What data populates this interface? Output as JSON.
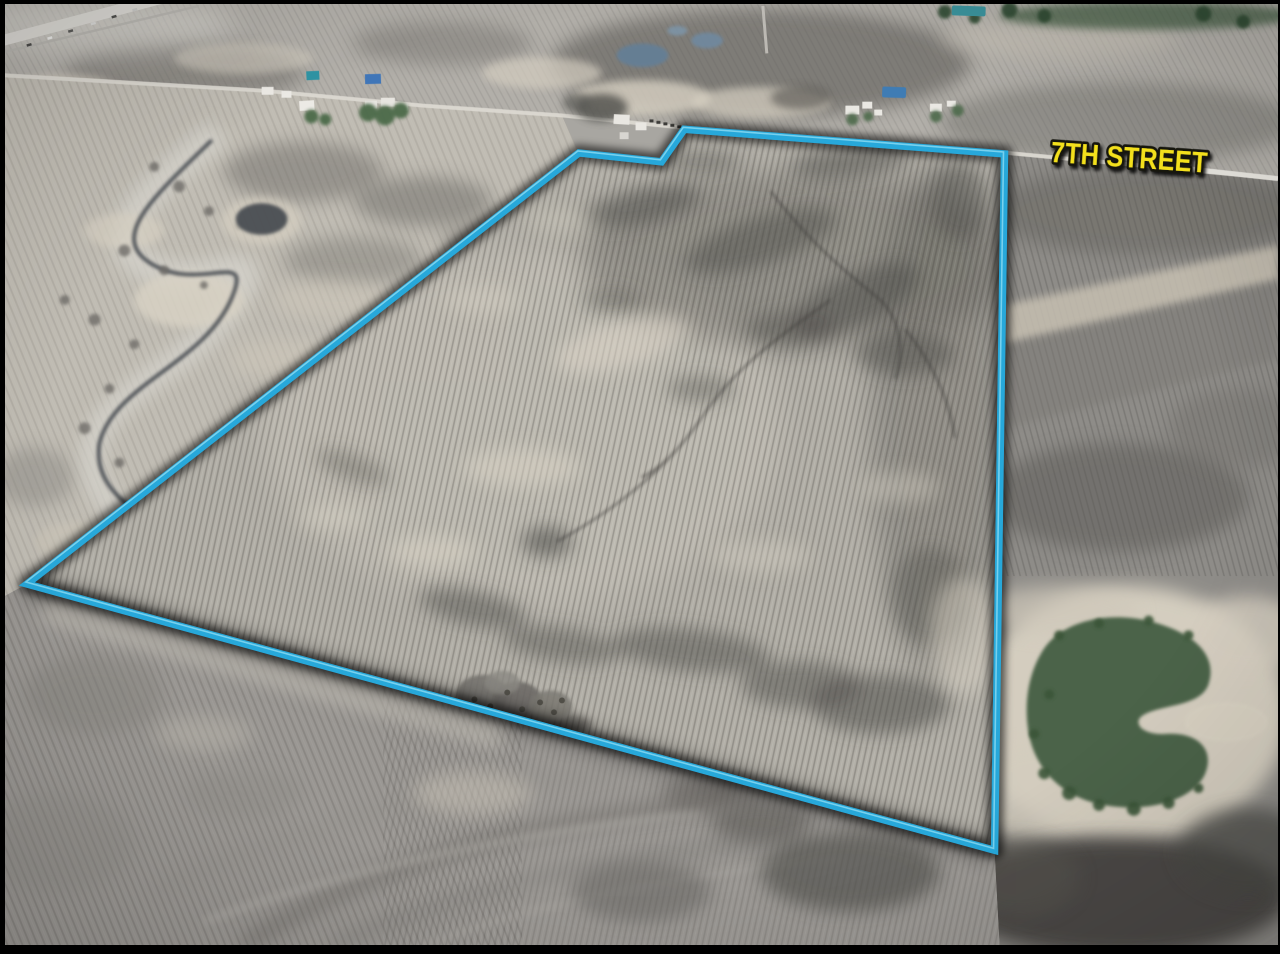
{
  "annotation": {
    "street_label": "7TH STREET",
    "street_label_color": "#f3e01c",
    "street_label_outline_color": "#17170f",
    "boundary_color": "#27a8da",
    "boundary_highlight_color": "#93dff4",
    "boundary_shadow_color": "#000000"
  },
  "scene": {
    "description": "Oblique aerial photo of bare spring farmland; a large tilled parcel is outlined in blue, bordered on the north by 7th Street; farmsteads line the road, a creek with frosty trees winds along the west side, and a green pond in a sandy area lies southeast of the parcel",
    "field_base_color": "#a8a6a1",
    "pond_color": "#4c6349",
    "sand_color": "#d8d1c2",
    "frame_color": "#000000"
  }
}
